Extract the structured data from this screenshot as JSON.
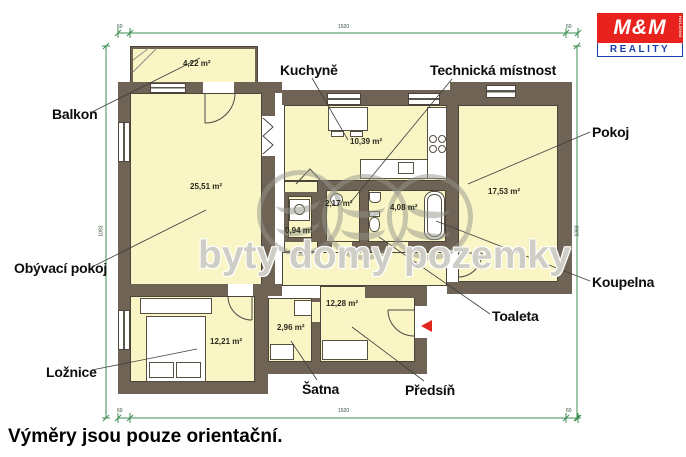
{
  "caption": {
    "text": "Výměry jsou pouze orientační."
  },
  "watermark": {
    "text": "byty domy pozemky"
  },
  "logo": {
    "mm": "M&M",
    "holding": "HOLDING",
    "reality": "REALITY"
  },
  "room_labels": [
    {
      "id": "balkon",
      "text": "Balkon"
    },
    {
      "id": "kuchyne",
      "text": "Kuchyně"
    },
    {
      "id": "technicka-mistnost",
      "text": "Technická místnost"
    },
    {
      "id": "pokoj",
      "text": "Pokoj"
    },
    {
      "id": "obyvaci-pokoj",
      "text": "Obývací pokoj"
    },
    {
      "id": "koupelna",
      "text": "Koupelna"
    },
    {
      "id": "toaleta",
      "text": "Toaleta"
    },
    {
      "id": "loznice",
      "text": "Ložnice"
    },
    {
      "id": "satna",
      "text": "Šatna"
    },
    {
      "id": "predsin",
      "text": "Předsíň"
    }
  ],
  "area_labels": [
    "4,22 m²",
    "25,51 m²",
    "10,39 m²",
    "2,17 m²",
    "4,08 m²",
    "0,94 m²",
    "17,53 m²",
    "12,28 m²",
    "2,96 m²",
    "12,21 m²"
  ],
  "dimensions": {
    "top_left": "60",
    "top_center": "1520",
    "top_right": "60",
    "bottom_left": "60",
    "bottom_center": "1520",
    "bottom_right": "60",
    "left_side": "1093",
    "right_side": "1093"
  },
  "colors": {
    "wall": "#6e6355",
    "room_fill": "#f9f5c5",
    "dimension_line": "#3e8e50",
    "entrance_arrow": "#e3261f",
    "logo_red": "#e8231d",
    "logo_blue": "#1b3fa8"
  }
}
